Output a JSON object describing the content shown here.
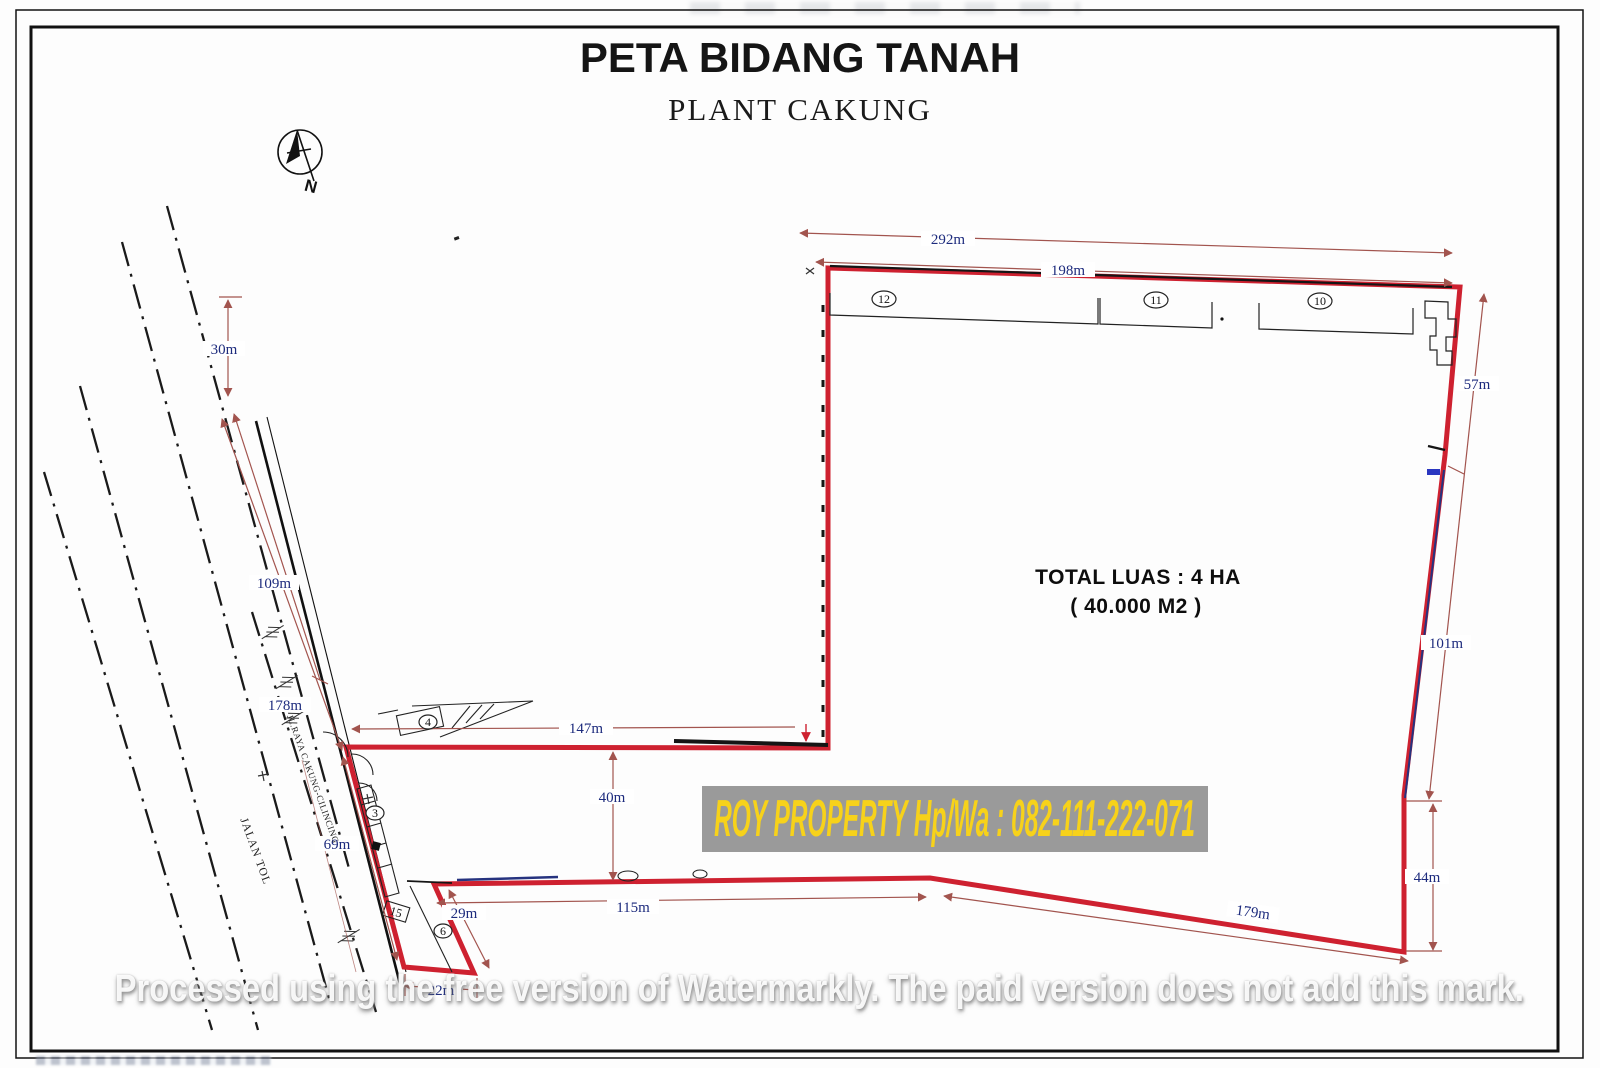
{
  "header": {
    "title": "PETA BIDANG TANAH",
    "subtitle": "PLANT CAKUNG"
  },
  "compass": {
    "north_label": "N"
  },
  "parcel": {
    "area_line1": "TOTAL LUAS : 4 HA",
    "area_line2": "( 40.000 M2 )"
  },
  "dimensions": {
    "top_outer": "292m",
    "top_inner": "198m",
    "right_upper": "57m",
    "right_middle": "101m",
    "right_lower": "44m",
    "bottom_right": "179m",
    "bottom_middle": "115m",
    "strip_side": "29m",
    "strip_bottom": "22m",
    "inner_bottom": "147m",
    "inner_gap": "40m",
    "road_top": "30m",
    "road_upper": "109m",
    "road_lower": "178m",
    "road_frontage": "69m"
  },
  "buildings": {
    "b12": "12",
    "b11": "11",
    "b10": "10",
    "b4": "4",
    "b3": "3",
    "b6": "6",
    "b15": "15"
  },
  "roads": {
    "toll_road": "JALAN TOL",
    "main_road": "JL.RAYA CAKUNG-CILINCING"
  },
  "banner": {
    "text": "ROY PROPERTY Hp/Wa : 082-111-222-071"
  },
  "watermark": {
    "text": "Processed using the free version of Watermarkly. The paid version does not add this mark."
  },
  "colors": {
    "boundary_red": "#ce2130",
    "dimension_line": "#a2544e",
    "dimension_label": "#1d2b7d",
    "banner_bg": "#9a9a9a",
    "banner_text": "#f7d21a"
  }
}
